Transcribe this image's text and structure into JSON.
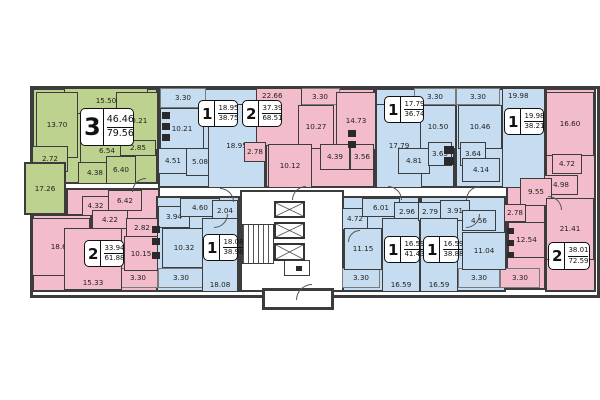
{
  "palette": {
    "green": "#bdd28e",
    "pink": "#f3bcca",
    "blue": "#c6ddf1",
    "wall": "#3c3c3c",
    "bg": "#ffffff"
  },
  "outline": {
    "x": 30,
    "y": 86,
    "w": 564,
    "h": 206
  },
  "zones": [
    {
      "c": "g",
      "x": 32,
      "y": 88,
      "w": 126,
      "h": 96
    },
    {
      "c": "b",
      "x": 158,
      "y": 88,
      "w": 107,
      "h": 100
    },
    {
      "c": "p",
      "x": 265,
      "y": 88,
      "w": 110,
      "h": 100
    },
    {
      "c": "b",
      "x": 375,
      "y": 88,
      "w": 80,
      "h": 100
    },
    {
      "c": "b",
      "x": 455,
      "y": 88,
      "w": 90,
      "h": 100
    },
    {
      "c": "p",
      "x": 545,
      "y": 88,
      "w": 51,
      "h": 204
    },
    {
      "c": "p",
      "x": 506,
      "y": 176,
      "w": 40,
      "h": 114
    },
    {
      "c": "p",
      "x": 66,
      "y": 188,
      "w": 94,
      "h": 104
    },
    {
      "c": "p",
      "x": 32,
      "y": 214,
      "w": 60,
      "h": 78
    },
    {
      "c": "b",
      "x": 156,
      "y": 196,
      "w": 84,
      "h": 96
    },
    {
      "c": "b",
      "x": 340,
      "y": 196,
      "w": 80,
      "h": 96
    },
    {
      "c": "b",
      "x": 420,
      "y": 196,
      "w": 86,
      "h": 96
    }
  ],
  "rooms": [
    {
      "a": "15.50",
      "x": 64,
      "y": 88,
      "w": 84,
      "h": 26,
      "c": "g"
    },
    {
      "a": "13.70",
      "x": 36,
      "y": 92,
      "w": 42,
      "h": 66,
      "c": "g"
    },
    {
      "a": "10.21",
      "x": 116,
      "y": 92,
      "w": 42,
      "h": 58,
      "c": "g"
    },
    {
      "a": "2.72",
      "x": 32,
      "y": 146,
      "w": 36,
      "h": 26,
      "c": "g"
    },
    {
      "a": "17.26",
      "x": 24,
      "y": 162,
      "w": 42,
      "h": 53,
      "c": "g",
      "out": true
    },
    {
      "a": "6.54",
      "x": 80,
      "y": 138,
      "w": 54,
      "h": 26,
      "c": "g"
    },
    {
      "a": "2.85",
      "x": 120,
      "y": 140,
      "w": 36,
      "h": 16,
      "c": "g"
    },
    {
      "a": "4.38",
      "x": 78,
      "y": 162,
      "w": 34,
      "h": 22,
      "c": "g"
    },
    {
      "a": "6.40",
      "x": 106,
      "y": 156,
      "w": 30,
      "h": 28,
      "c": "g"
    },
    {
      "a": "3.30",
      "x": 160,
      "y": 88,
      "w": 46,
      "h": 20,
      "c": "b",
      "b": true
    },
    {
      "a": "10.21",
      "x": 160,
      "y": 108,
      "w": 44,
      "h": 42,
      "c": "b"
    },
    {
      "a": "4.51",
      "x": 158,
      "y": 148,
      "w": 30,
      "h": 26,
      "c": "b"
    },
    {
      "a": "5.08",
      "x": 186,
      "y": 148,
      "w": 28,
      "h": 28,
      "c": "b"
    },
    {
      "a": "18.95",
      "x": 208,
      "y": 104,
      "w": 57,
      "h": 84,
      "c": "b"
    },
    {
      "a": "22.66",
      "x": 256,
      "y": 88,
      "w": 46,
      "h": 58,
      "c": "p",
      "lp": "t"
    },
    {
      "a": "3.30",
      "x": 300,
      "y": 88,
      "w": 40,
      "h": 17,
      "c": "p",
      "b": true
    },
    {
      "a": "10.27",
      "x": 298,
      "y": 105,
      "w": 36,
      "h": 44,
      "c": "p"
    },
    {
      "a": "14.73",
      "x": 336,
      "y": 92,
      "w": 40,
      "h": 58,
      "c": "p"
    },
    {
      "a": "2.78",
      "x": 244,
      "y": 142,
      "w": 22,
      "h": 20,
      "c": "p"
    },
    {
      "a": "10.12",
      "x": 268,
      "y": 144,
      "w": 44,
      "h": 44,
      "c": "p"
    },
    {
      "a": "4.39",
      "x": 320,
      "y": 144,
      "w": 30,
      "h": 26,
      "c": "p"
    },
    {
      "a": "3.56",
      "x": 350,
      "y": 144,
      "w": 24,
      "h": 26,
      "c": "p"
    },
    {
      "a": "17.79",
      "x": 376,
      "y": 104,
      "w": 46,
      "h": 84,
      "c": "b"
    },
    {
      "a": "3.30",
      "x": 414,
      "y": 88,
      "w": 42,
      "h": 17,
      "c": "b",
      "b": true
    },
    {
      "a": "10.50",
      "x": 420,
      "y": 105,
      "w": 36,
      "h": 44,
      "c": "b"
    },
    {
      "a": "4.81",
      "x": 398,
      "y": 148,
      "w": 32,
      "h": 26,
      "c": "b"
    },
    {
      "a": "3.65",
      "x": 428,
      "y": 142,
      "w": 24,
      "h": 24,
      "c": "b"
    },
    {
      "a": "3.30",
      "x": 456,
      "y": 88,
      "w": 44,
      "h": 17,
      "c": "b",
      "b": true
    },
    {
      "a": "10.46",
      "x": 458,
      "y": 105,
      "w": 44,
      "h": 44,
      "c": "b"
    },
    {
      "a": "3.64",
      "x": 460,
      "y": 142,
      "w": 26,
      "h": 24,
      "c": "b"
    },
    {
      "a": "4.14",
      "x": 462,
      "y": 158,
      "w": 38,
      "h": 24,
      "c": "b"
    },
    {
      "a": "19.98",
      "x": 502,
      "y": 88,
      "w": 43,
      "h": 100,
      "c": "b",
      "lp": "t"
    },
    {
      "a": "16.60",
      "x": 546,
      "y": 92,
      "w": 48,
      "h": 64,
      "c": "p"
    },
    {
      "a": "4.72",
      "x": 552,
      "y": 154,
      "w": 30,
      "h": 20,
      "c": "p"
    },
    {
      "a": "4.98",
      "x": 544,
      "y": 175,
      "w": 34,
      "h": 20,
      "c": "p"
    },
    {
      "a": "9.55",
      "x": 520,
      "y": 178,
      "w": 32,
      "h": 28,
      "c": "p"
    },
    {
      "a": "21.41",
      "x": 546,
      "y": 198,
      "w": 48,
      "h": 62,
      "c": "p"
    },
    {
      "a": "2.78",
      "x": 504,
      "y": 204,
      "w": 22,
      "h": 18,
      "c": "p"
    },
    {
      "a": "12.54",
      "x": 508,
      "y": 222,
      "w": 37,
      "h": 36,
      "c": "p"
    },
    {
      "a": "3.30",
      "x": 500,
      "y": 268,
      "w": 40,
      "h": 20,
      "c": "p",
      "b": true
    },
    {
      "a": "18.61",
      "x": 32,
      "y": 218,
      "w": 58,
      "h": 58,
      "c": "p"
    },
    {
      "a": "15.33",
      "x": 64,
      "y": 228,
      "w": 58,
      "h": 62,
      "c": "p",
      "lp": "b"
    },
    {
      "a": "6.42",
      "x": 108,
      "y": 190,
      "w": 34,
      "h": 21,
      "c": "p"
    },
    {
      "a": "4.32",
      "x": 82,
      "y": 196,
      "w": 27,
      "h": 20,
      "c": "p"
    },
    {
      "a": "4.22",
      "x": 92,
      "y": 210,
      "w": 36,
      "h": 19,
      "c": "p"
    },
    {
      "a": "2.82",
      "x": 126,
      "y": 218,
      "w": 32,
      "h": 19,
      "c": "p"
    },
    {
      "a": "10.15",
      "x": 124,
      "y": 236,
      "w": 34,
      "h": 35,
      "c": "p"
    },
    {
      "a": "3.30",
      "x": 118,
      "y": 268,
      "w": 40,
      "h": 20,
      "c": "p",
      "b": true
    },
    {
      "a": "3.94",
      "x": 158,
      "y": 206,
      "w": 32,
      "h": 22,
      "c": "b"
    },
    {
      "a": "4.60",
      "x": 180,
      "y": 198,
      "w": 40,
      "h": 19,
      "c": "b"
    },
    {
      "a": "2.04",
      "x": 212,
      "y": 200,
      "w": 26,
      "h": 22,
      "c": "b"
    },
    {
      "a": "10.32",
      "x": 162,
      "y": 228,
      "w": 44,
      "h": 40,
      "c": "b"
    },
    {
      "a": "3.30",
      "x": 158,
      "y": 268,
      "w": 46,
      "h": 20,
      "c": "b",
      "b": true
    },
    {
      "a": "18.08",
      "x": 202,
      "y": 218,
      "w": 36,
      "h": 74,
      "c": "b",
      "lp": "b"
    },
    {
      "a": "4.72",
      "x": 342,
      "y": 208,
      "w": 26,
      "h": 22,
      "c": "b"
    },
    {
      "a": "6.01",
      "x": 362,
      "y": 198,
      "w": 38,
      "h": 19,
      "c": "b"
    },
    {
      "a": "2.96",
      "x": 394,
      "y": 202,
      "w": 26,
      "h": 19,
      "c": "b"
    },
    {
      "a": "11.15",
      "x": 344,
      "y": 228,
      "w": 38,
      "h": 42,
      "c": "b"
    },
    {
      "a": "3.30",
      "x": 342,
      "y": 268,
      "w": 38,
      "h": 20,
      "c": "b",
      "b": true
    },
    {
      "a": "16.59",
      "x": 382,
      "y": 218,
      "w": 38,
      "h": 74,
      "c": "b",
      "lp": "b"
    },
    {
      "a": "2.79",
      "x": 418,
      "y": 202,
      "w": 24,
      "h": 19,
      "c": "b"
    },
    {
      "a": "3.91",
      "x": 440,
      "y": 200,
      "w": 30,
      "h": 21,
      "c": "b"
    },
    {
      "a": "4.56",
      "x": 462,
      "y": 210,
      "w": 34,
      "h": 21,
      "c": "b"
    },
    {
      "a": "16.59",
      "x": 420,
      "y": 218,
      "w": 38,
      "h": 74,
      "c": "b",
      "lp": "b"
    },
    {
      "a": "11.04",
      "x": 462,
      "y": 232,
      "w": 44,
      "h": 38,
      "c": "b"
    },
    {
      "a": "3.30",
      "x": 458,
      "y": 268,
      "w": 42,
      "h": 20,
      "c": "b",
      "b": true
    }
  ],
  "badges": [
    {
      "num": "3",
      "living": "46.46",
      "total": "79.56",
      "x": 80,
      "y": 108,
      "w": 54,
      "h": 38,
      "big": true
    },
    {
      "num": "1",
      "living": "18.95",
      "total": "38.75",
      "x": 198,
      "y": 100,
      "w": 40,
      "h": 27
    },
    {
      "num": "2",
      "living": "37.39",
      "total": "68.51",
      "x": 242,
      "y": 100,
      "w": 40,
      "h": 27
    },
    {
      "num": "1",
      "living": "17.79",
      "total": "36.74",
      "x": 384,
      "y": 96,
      "w": 40,
      "h": 27
    },
    {
      "num": "1",
      "living": "19.98",
      "total": "38.21",
      "x": 504,
      "y": 108,
      "w": 40,
      "h": 27
    },
    {
      "num": "2",
      "living": "38.01",
      "total": "72.59",
      "x": 548,
      "y": 242,
      "w": 42,
      "h": 28
    },
    {
      "num": "2",
      "living": "33.94",
      "total": "61.88",
      "x": 84,
      "y": 240,
      "w": 40,
      "h": 27
    },
    {
      "num": "1",
      "living": "18.08",
      "total": "38.98",
      "x": 203,
      "y": 234,
      "w": 35,
      "h": 27
    },
    {
      "num": "1",
      "living": "16.59",
      "total": "41.43",
      "x": 384,
      "y": 236,
      "w": 36,
      "h": 27
    },
    {
      "num": "1",
      "living": "16.59",
      "total": "38.88",
      "x": 423,
      "y": 236,
      "w": 36,
      "h": 27
    }
  ],
  "core": {
    "lobby": {
      "x": 240,
      "y": 190,
      "w": 104,
      "h": 102
    },
    "stairs": {
      "x": 242,
      "y": 224,
      "w": 32,
      "h": 40
    },
    "elevators": [
      {
        "x": 274,
        "y": 201,
        "w": 31,
        "h": 17
      },
      {
        "x": 274,
        "y": 222,
        "w": 31,
        "h": 17
      },
      {
        "x": 274,
        "y": 243,
        "w": 31,
        "h": 18
      }
    ],
    "utility": {
      "x": 284,
      "y": 260,
      "w": 26,
      "h": 16
    },
    "vestibule": {
      "x": 262,
      "y": 288,
      "w": 72,
      "h": 22
    }
  },
  "fixtures": [
    {
      "x": 162,
      "y": 112,
      "w": 8,
      "h": 7
    },
    {
      "x": 162,
      "y": 123,
      "w": 8,
      "h": 7
    },
    {
      "x": 162,
      "y": 134,
      "w": 8,
      "h": 7
    },
    {
      "x": 348,
      "y": 130,
      "w": 8,
      "h": 7
    },
    {
      "x": 348,
      "y": 141,
      "w": 8,
      "h": 7
    },
    {
      "x": 152,
      "y": 226,
      "w": 8,
      "h": 7
    },
    {
      "x": 152,
      "y": 238,
      "w": 8,
      "h": 7
    },
    {
      "x": 152,
      "y": 252,
      "w": 8,
      "h": 7
    },
    {
      "x": 507,
      "y": 228,
      "w": 7,
      "h": 6
    },
    {
      "x": 507,
      "y": 240,
      "w": 7,
      "h": 6
    },
    {
      "x": 507,
      "y": 252,
      "w": 7,
      "h": 6
    },
    {
      "x": 444,
      "y": 146,
      "w": 10,
      "h": 8
    },
    {
      "x": 444,
      "y": 157,
      "w": 10,
      "h": 8
    },
    {
      "x": 296,
      "y": 266,
      "w": 6,
      "h": 5
    }
  ],
  "doors": [
    {
      "x": 132,
      "y": 178,
      "s": 14,
      "r": 0
    },
    {
      "x": 220,
      "y": 188,
      "s": 14,
      "r": 90
    },
    {
      "x": 292,
      "y": 186,
      "s": 14,
      "r": 0
    },
    {
      "x": 388,
      "y": 186,
      "s": 14,
      "r": 90
    },
    {
      "x": 466,
      "y": 186,
      "s": 14,
      "r": 0
    },
    {
      "x": 214,
      "y": 214,
      "s": 14,
      "r": 180
    },
    {
      "x": 466,
      "y": 214,
      "s": 14,
      "r": 180
    },
    {
      "x": 296,
      "y": 284,
      "s": 16,
      "r": 0
    },
    {
      "x": 548,
      "y": 196,
      "s": 14,
      "r": 90
    },
    {
      "x": 348,
      "y": 230,
      "s": 12,
      "r": 0
    }
  ]
}
